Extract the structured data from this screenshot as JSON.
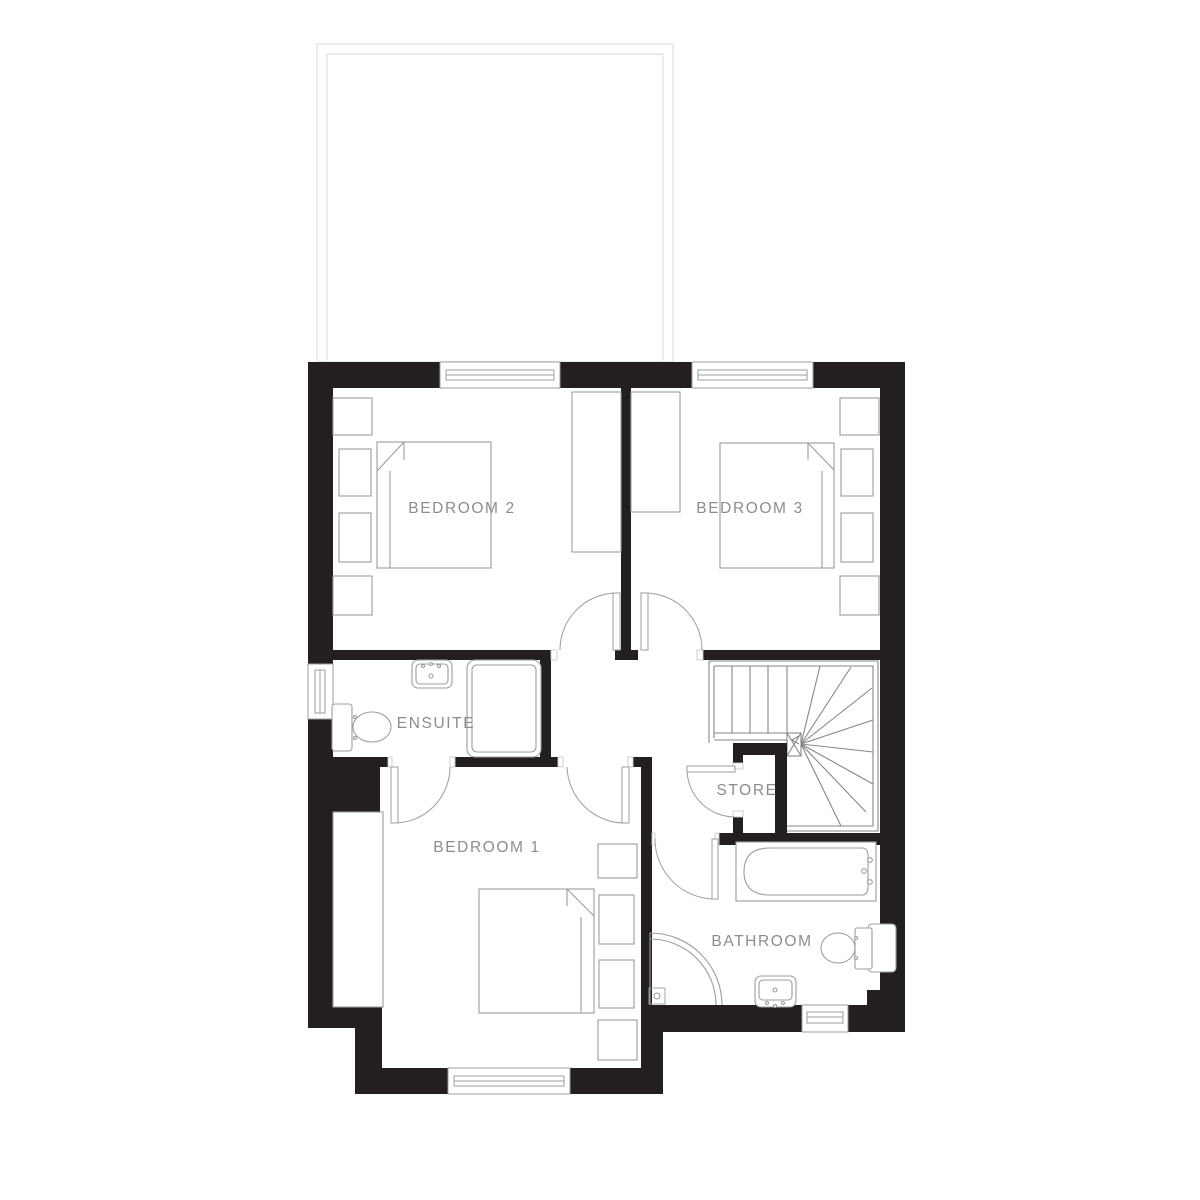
{
  "page": {
    "type": "floor-plan",
    "background": "#ffffff"
  },
  "palette": {
    "wall": "#231f20",
    "furniture_line": "#9b9da0",
    "stair_line": "#85878a",
    "label_text": "#8a8c8f",
    "faint_outline": "#ebebeb",
    "frame_line": "#c9cacb"
  },
  "floor_plan": {
    "rooms": [
      {
        "id": "bedroom-2",
        "label": "BEDROOM 2"
      },
      {
        "id": "bedroom-3",
        "label": "BEDROOM 3"
      },
      {
        "id": "ensuite",
        "label": "ENSUITE"
      },
      {
        "id": "store",
        "label": "STORE"
      },
      {
        "id": "bedroom-1",
        "label": "BEDROOM 1"
      },
      {
        "id": "bathroom",
        "label": "BATHROOM"
      }
    ],
    "fixtures": [
      "double-bed",
      "wardrobe",
      "bedside-units",
      "toilet",
      "washbasin",
      "shower-enclosure",
      "corner-shower",
      "bath",
      "staircase-with-winders",
      "window",
      "door-swing"
    ]
  }
}
